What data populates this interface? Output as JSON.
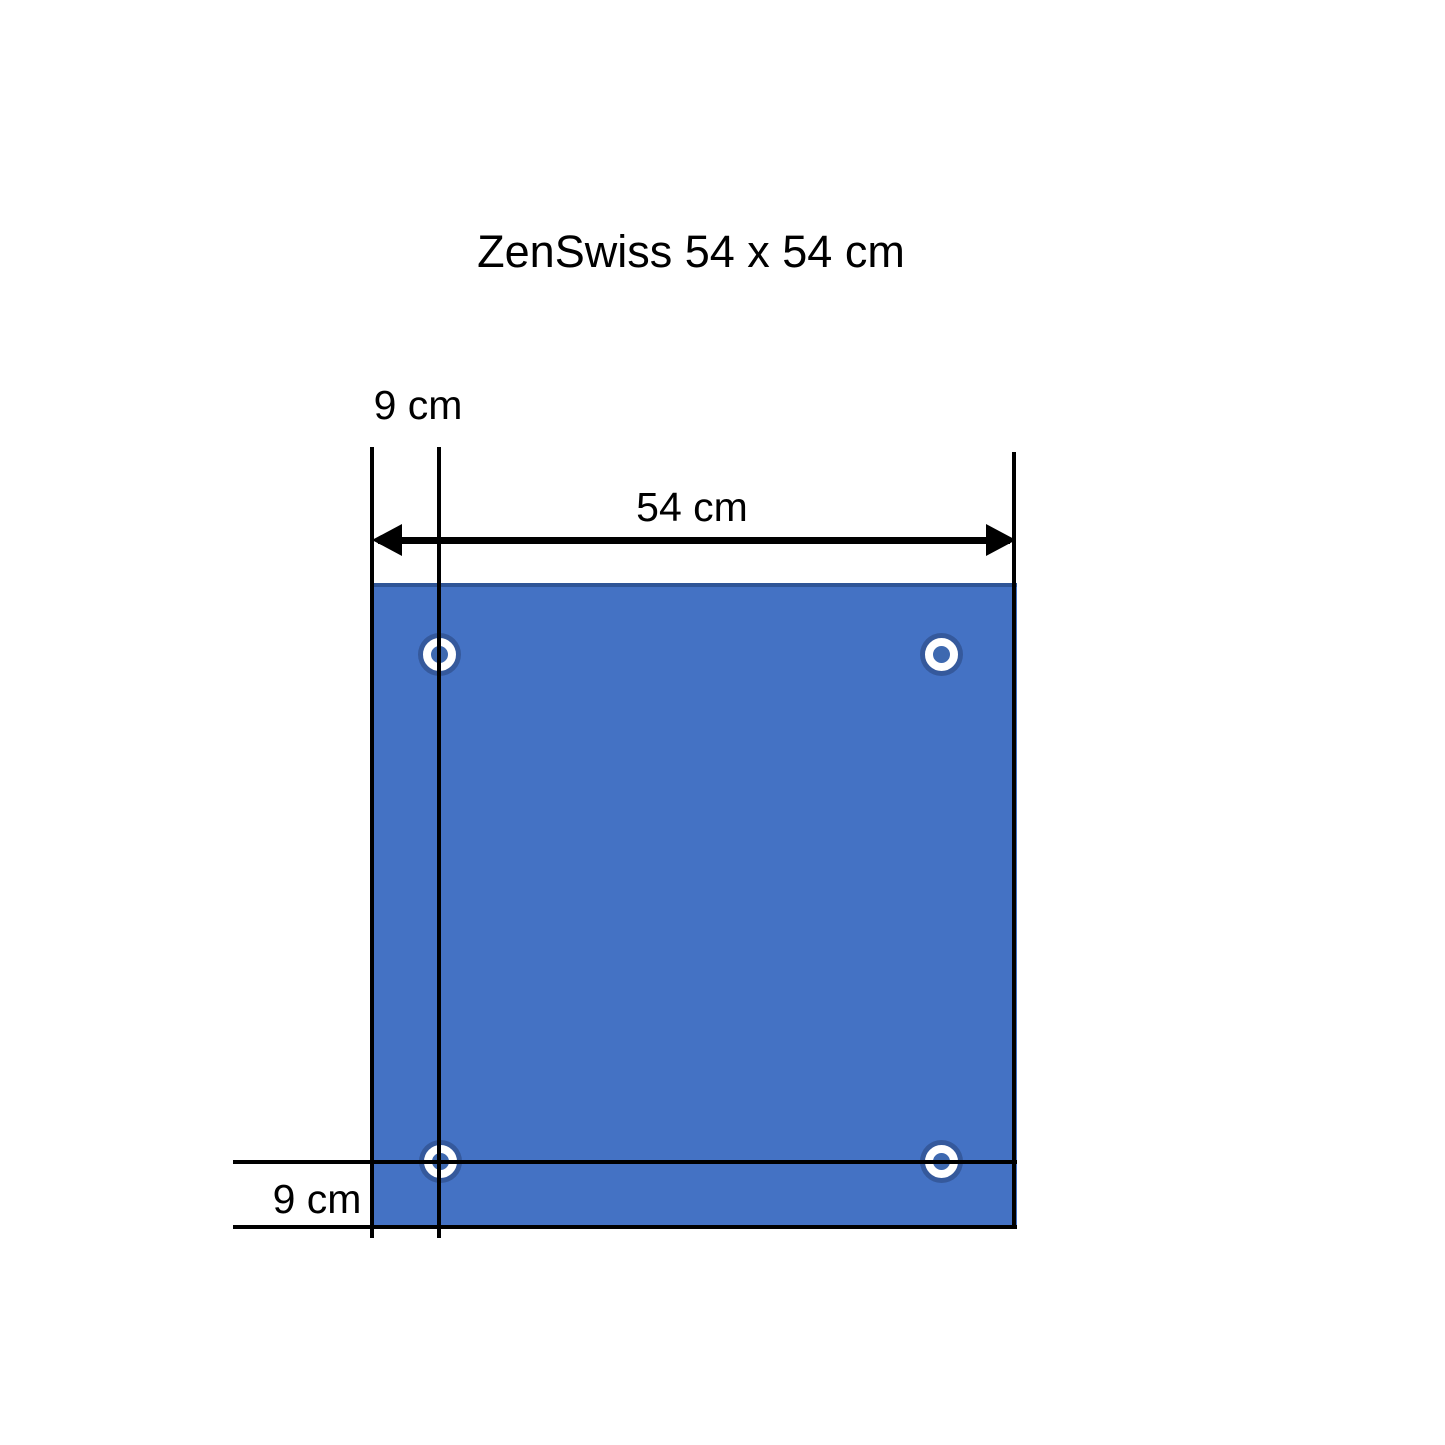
{
  "drawing": {
    "title": "ZenSwiss 54 x 54 cm",
    "labels": {
      "width": "54 cm",
      "grommet_offset_top": "9 cm",
      "grommet_offset_bottom": "9 cm"
    },
    "panel": {
      "width_cm": 54,
      "height_cm": 54,
      "grommet_offset_cm": 9,
      "grommet_count": 4,
      "fill_color": "#4472C4",
      "edge_color": "#2F5597"
    },
    "grommet_colors": {
      "outer_ring": "#35599C",
      "eyelet": "#FFFFFF",
      "hole": "#3E69B0"
    },
    "line_color": "#000000"
  }
}
